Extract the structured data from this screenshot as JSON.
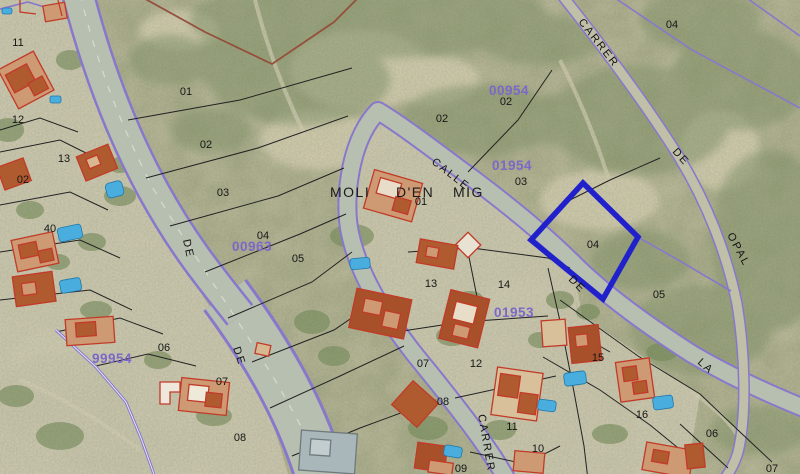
{
  "map": {
    "type": "cadastral-aerial-view",
    "selected_parcel": {
      "number": "04",
      "outline_color": "#2121cc"
    },
    "colors": {
      "parcel_boundary_purple": "#8878cc",
      "parcel_line_black": "#222222",
      "boundary_maroon": "#94503c",
      "building_outline_red": "#c23a28",
      "pool_blue": "#49aede",
      "sheet_code_purple": "#7b68c8",
      "road_fill": "#b7bfb0",
      "selection_blue": "#2121cc"
    },
    "street_labels": [
      {
        "text": "CARRER",
        "x": 578,
        "y": 22,
        "rot": 52,
        "size": "normal"
      },
      {
        "text": "DE",
        "x": 672,
        "y": 152,
        "rot": 48,
        "size": "normal"
      },
      {
        "text": "OPAL",
        "x": 727,
        "y": 235,
        "rot": 62,
        "size": "normal"
      },
      {
        "text": "CALLE",
        "x": 431,
        "y": 163,
        "rot": 38,
        "size": "normal"
      },
      {
        "text": "MOLI",
        "x": 330,
        "y": 197,
        "rot": 0,
        "size": "big"
      },
      {
        "text": "D'EN",
        "x": 396,
        "y": 197,
        "rot": 0,
        "size": "big"
      },
      {
        "text": "MIG",
        "x": 453,
        "y": 197,
        "rot": 0,
        "size": "big"
      },
      {
        "text": "DE",
        "x": 568,
        "y": 280,
        "rot": 45,
        "size": "normal"
      },
      {
        "text": "LA",
        "x": 697,
        "y": 363,
        "rot": 42,
        "size": "normal"
      },
      {
        "text": "DE",
        "x": 183,
        "y": 240,
        "rot": 78,
        "size": "normal"
      },
      {
        "text": "DE",
        "x": 233,
        "y": 348,
        "rot": 72,
        "size": "normal"
      },
      {
        "text": "CARRER",
        "x": 478,
        "y": 415,
        "rot": 80,
        "size": "normal"
      }
    ],
    "sheet_codes": [
      {
        "text": "00954",
        "x": 489,
        "y": 95
      },
      {
        "text": "01954",
        "x": 492,
        "y": 170
      },
      {
        "text": "00963",
        "x": 232,
        "y": 251
      },
      {
        "text": "99954",
        "x": 92,
        "y": 363
      },
      {
        "text": "01953",
        "x": 494,
        "y": 317
      }
    ],
    "parcel_numbers": [
      {
        "text": "11",
        "x": 18,
        "y": 46
      },
      {
        "text": "12",
        "x": 18,
        "y": 123
      },
      {
        "text": "13",
        "x": 64,
        "y": 162
      },
      {
        "text": "02",
        "x": 23,
        "y": 183
      },
      {
        "text": "40",
        "x": 50,
        "y": 232
      },
      {
        "text": "01",
        "x": 186,
        "y": 95
      },
      {
        "text": "02",
        "x": 206,
        "y": 148
      },
      {
        "text": "03",
        "x": 223,
        "y": 196
      },
      {
        "text": "04",
        "x": 263,
        "y": 239
      },
      {
        "text": "05",
        "x": 298,
        "y": 262
      },
      {
        "text": "06",
        "x": 164,
        "y": 351
      },
      {
        "text": "07",
        "x": 222,
        "y": 385
      },
      {
        "text": "08",
        "x": 240,
        "y": 441
      },
      {
        "text": "01",
        "x": 421,
        "y": 205
      },
      {
        "text": "02",
        "x": 442,
        "y": 122
      },
      {
        "text": "02",
        "x": 506,
        "y": 105
      },
      {
        "text": "03",
        "x": 521,
        "y": 185
      },
      {
        "text": "04",
        "x": 593,
        "y": 248
      },
      {
        "text": "05",
        "x": 659,
        "y": 298
      },
      {
        "text": "04",
        "x": 672,
        "y": 28
      },
      {
        "text": "13",
        "x": 431,
        "y": 287
      },
      {
        "text": "14",
        "x": 504,
        "y": 288
      },
      {
        "text": "07",
        "x": 423,
        "y": 367
      },
      {
        "text": "12",
        "x": 476,
        "y": 367
      },
      {
        "text": "08",
        "x": 443,
        "y": 405
      },
      {
        "text": "11",
        "x": 512,
        "y": 430
      },
      {
        "text": "10",
        "x": 538,
        "y": 452
      },
      {
        "text": "09",
        "x": 461,
        "y": 472
      },
      {
        "text": "15",
        "x": 598,
        "y": 361
      },
      {
        "text": "16",
        "x": 642,
        "y": 418
      },
      {
        "text": "06",
        "x": 712,
        "y": 437
      },
      {
        "text": "07",
        "x": 772,
        "y": 472
      }
    ]
  }
}
